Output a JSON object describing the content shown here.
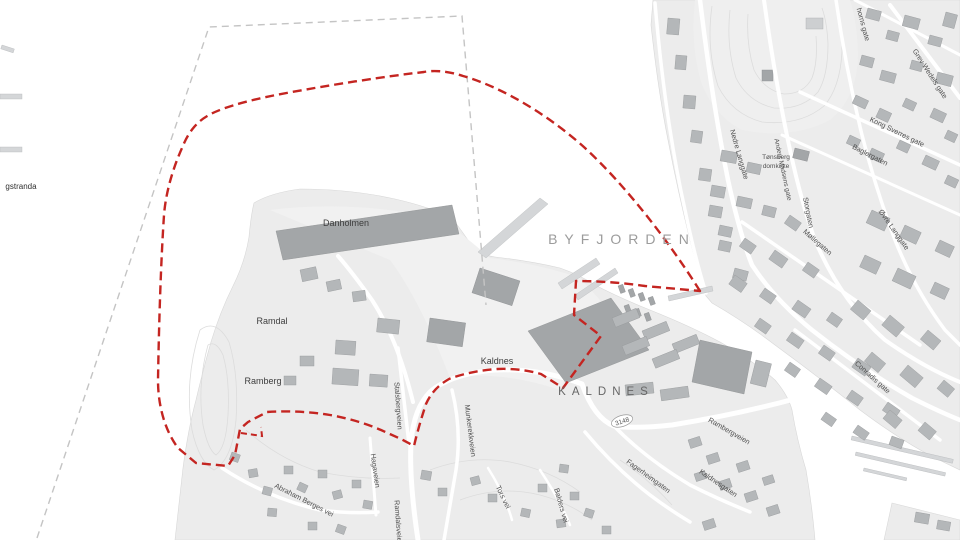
{
  "map": {
    "description": "Grayscale city map of Tønsberg / Kaldnes with red dashed planning boundary over Byfjorden",
    "water_label": "BYFJORDEN",
    "area_labels": [
      "KALDNES",
      "Kaldnes",
      "Danholmen",
      "Ramdal",
      "Ramberg"
    ],
    "poi_label_lines": [
      "Tønsberg",
      "domkirke"
    ],
    "edge_labels": [
      "gstranda",
      "horns gate"
    ],
    "street_labels": [
      "Nedre Langgate",
      "Grev Wedels gate",
      "Kong Sverres gate",
      "Baglergaten",
      "Møllegaten",
      "Øvre Langgate",
      "Storgaten",
      "Anders Madsens gate",
      "Conradis gate",
      "Rambergveien",
      "Kaldnesgaten",
      "Fagerheimgaten",
      "Munkerekkveien",
      "Stalsbergveien",
      "Hagaveien",
      "Ramdalsveien",
      "Abraham Berges vei",
      "Tors vei",
      "Balders vei"
    ],
    "road_shield": "3148",
    "colors": {
      "boundary_red": "#c42521",
      "boundary_gray": "#c4c4c4",
      "water": "#ffffff",
      "land": "#ececec",
      "building": "#b4b7b9",
      "building_dark": "#a3a6a8",
      "road": "#ffffff",
      "contour": "#dcdcdc",
      "water_label_gray": "#9c9c9c"
    }
  }
}
